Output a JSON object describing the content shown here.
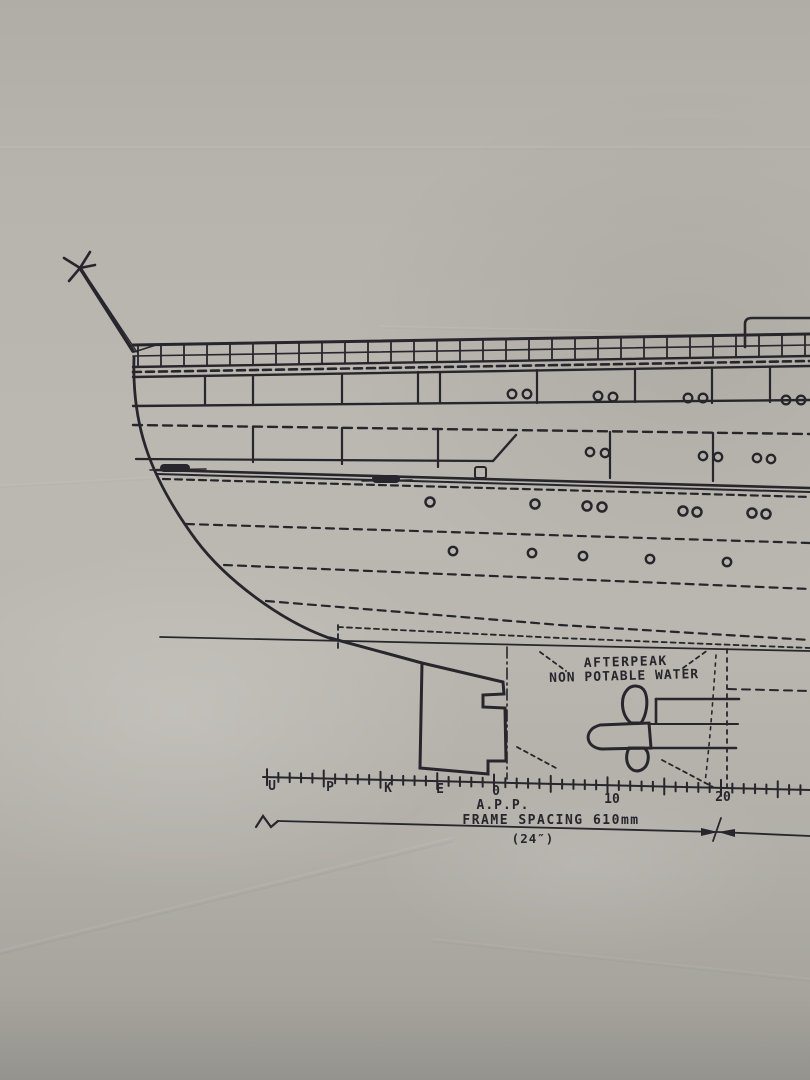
{
  "drawing": {
    "ink_color": "#26262c",
    "paper_color": "#b7b4ad",
    "afterpeak_label": {
      "line1": "AFTERPEAK",
      "line2": "NON POTABLE WATER"
    },
    "frame_scale": {
      "letters": [
        "U",
        "P",
        "K",
        "E"
      ],
      "origin": "0",
      "app": "A.P.P.",
      "numbers": [
        "10",
        "20"
      ]
    },
    "dimension": {
      "text": "FRAME SPACING 610mm",
      "inches": "(24″)"
    }
  }
}
